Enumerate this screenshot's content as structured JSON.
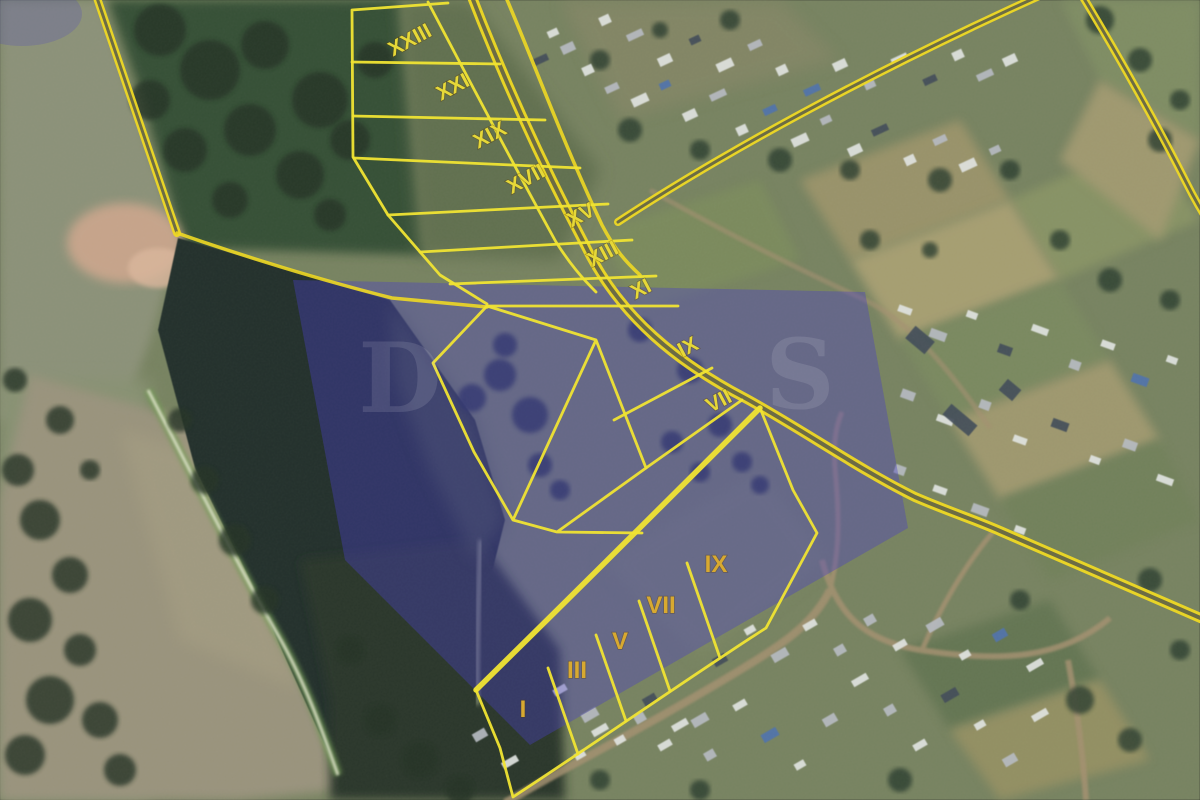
{
  "map": {
    "type": "satellite-cadastral-plan",
    "parcel_labels_upper": [
      {
        "text": "XXIII",
        "x": 413,
        "y": 46
      },
      {
        "text": "XXI",
        "x": 456,
        "y": 93
      },
      {
        "text": "XIX",
        "x": 493,
        "y": 141
      },
      {
        "text": "XVII",
        "x": 529,
        "y": 185
      },
      {
        "text": "XV",
        "x": 584,
        "y": 221
      },
      {
        "text": "XIII",
        "x": 606,
        "y": 260
      },
      {
        "text": "XI",
        "x": 644,
        "y": 295
      },
      {
        "text": "IX",
        "x": 691,
        "y": 353
      },
      {
        "text": "VII",
        "x": 722,
        "y": 407
      }
    ],
    "parcel_labels_lower": [
      {
        "text": "IX",
        "x": 716,
        "y": 572
      },
      {
        "text": "VII",
        "x": 661,
        "y": 613
      },
      {
        "text": "V",
        "x": 620,
        "y": 649
      },
      {
        "text": "III",
        "x": 577,
        "y": 678
      },
      {
        "text": "I",
        "x": 523,
        "y": 717
      }
    ],
    "label_rotation_upper_deg": -28,
    "label_rotation_lower_deg": 0,
    "watermark_letters": [
      {
        "char": "D",
        "x": 400,
        "y": 412
      },
      {
        "char": "S",
        "x": 800,
        "y": 408
      }
    ],
    "colors": {
      "parcel_line": "#f0e433",
      "road_line": "#eed824",
      "road_core": "#5f6148",
      "label_upper": "#e6d838",
      "label_lower": "#d8a930",
      "overlay_purple": "#4a3fc4",
      "water": "#1a2723",
      "field_tan": "#9a927a",
      "forest": "#2f4a2e"
    }
  }
}
